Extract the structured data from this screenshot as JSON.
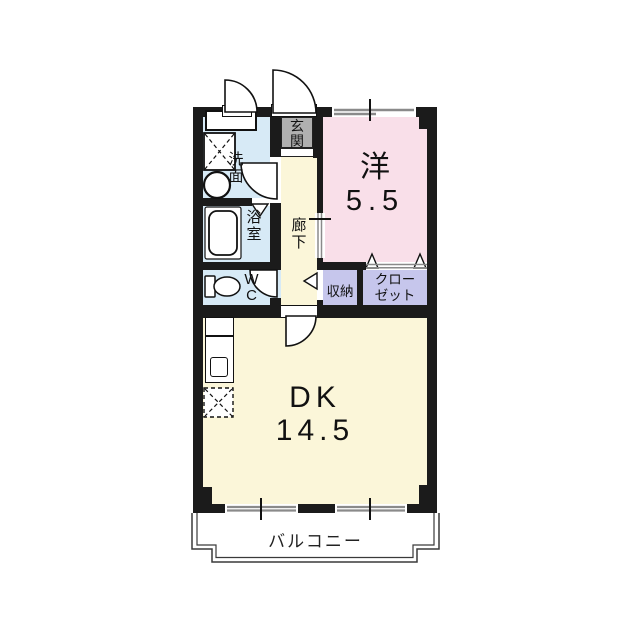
{
  "plan": {
    "rooms": {
      "entrance": {
        "label": "玄関"
      },
      "washroom": {
        "label": "洗面"
      },
      "bathroom": {
        "label": "浴室"
      },
      "toilet": {
        "label": "WC"
      },
      "hallway": {
        "label": "廊下"
      },
      "western_room": {
        "label": "洋",
        "size": "5.5"
      },
      "storage": {
        "label": "収納"
      },
      "closet": {
        "label": "クローゼット",
        "lines": [
          "クロー",
          "ゼット"
        ]
      },
      "dining_kitchen": {
        "label": "DK",
        "size": "14.5"
      },
      "balcony": {
        "label": "バルコニー"
      }
    },
    "colors": {
      "wall": "#1b1b1b",
      "wet-room": "#d7eaf6",
      "western-room": "#f9dfe9",
      "floor": "#fbf6d9",
      "closet": "#c6c6ec",
      "entrance": "#b0b0b0",
      "window-line": "#8a8a8a"
    }
  }
}
